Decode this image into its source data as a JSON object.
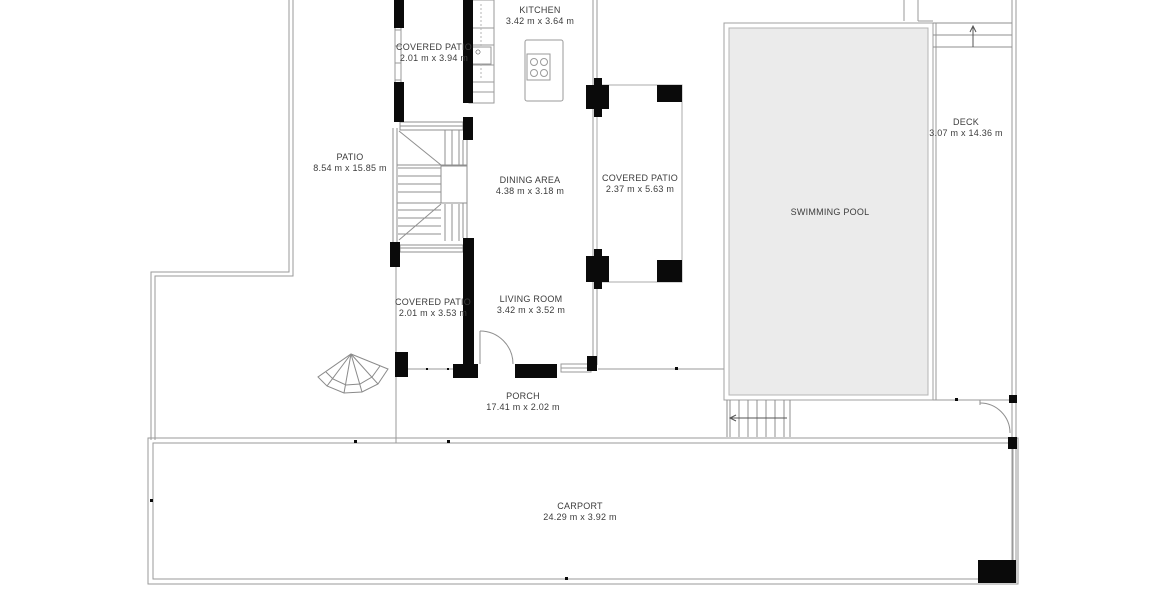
{
  "plan_title": "Floor plan",
  "rooms": [
    {
      "id": "kitchen",
      "name": "KITCHEN",
      "dims": "3.42 m x 3.64 m"
    },
    {
      "id": "covered-patio-top",
      "name": "COVERED PATIO",
      "dims": "2.01 m x 3.94 m"
    },
    {
      "id": "patio",
      "name": "PATIO",
      "dims": "8.54 m x 15.85 m"
    },
    {
      "id": "dining-area",
      "name": "DINING AREA",
      "dims": "4.38 m x 3.18 m"
    },
    {
      "id": "covered-patio-right",
      "name": "COVERED PATIO",
      "dims": "2.37 m x 5.63 m"
    },
    {
      "id": "swimming-pool",
      "name": "SWIMMING POOL",
      "dims": ""
    },
    {
      "id": "deck",
      "name": "DECK",
      "dims": "3.07 m x 14.36 m"
    },
    {
      "id": "covered-patio-bottom",
      "name": "COVERED PATIO",
      "dims": "2.01 m x 3.53 m"
    },
    {
      "id": "living-room",
      "name": "LIVING ROOM",
      "dims": "3.42 m x 3.52 m"
    },
    {
      "id": "porch",
      "name": "PORCH",
      "dims": "17.41 m x 2.02 m"
    },
    {
      "id": "carport",
      "name": "CARPORT",
      "dims": "24.29 m x 3.92 m"
    }
  ],
  "colors": {
    "wall": "#0a0a0a",
    "thin_line": "#9a9a9a",
    "pool_fill": "#ebebeb",
    "label_text": "#3c3c3c",
    "background": "#ffffff"
  }
}
